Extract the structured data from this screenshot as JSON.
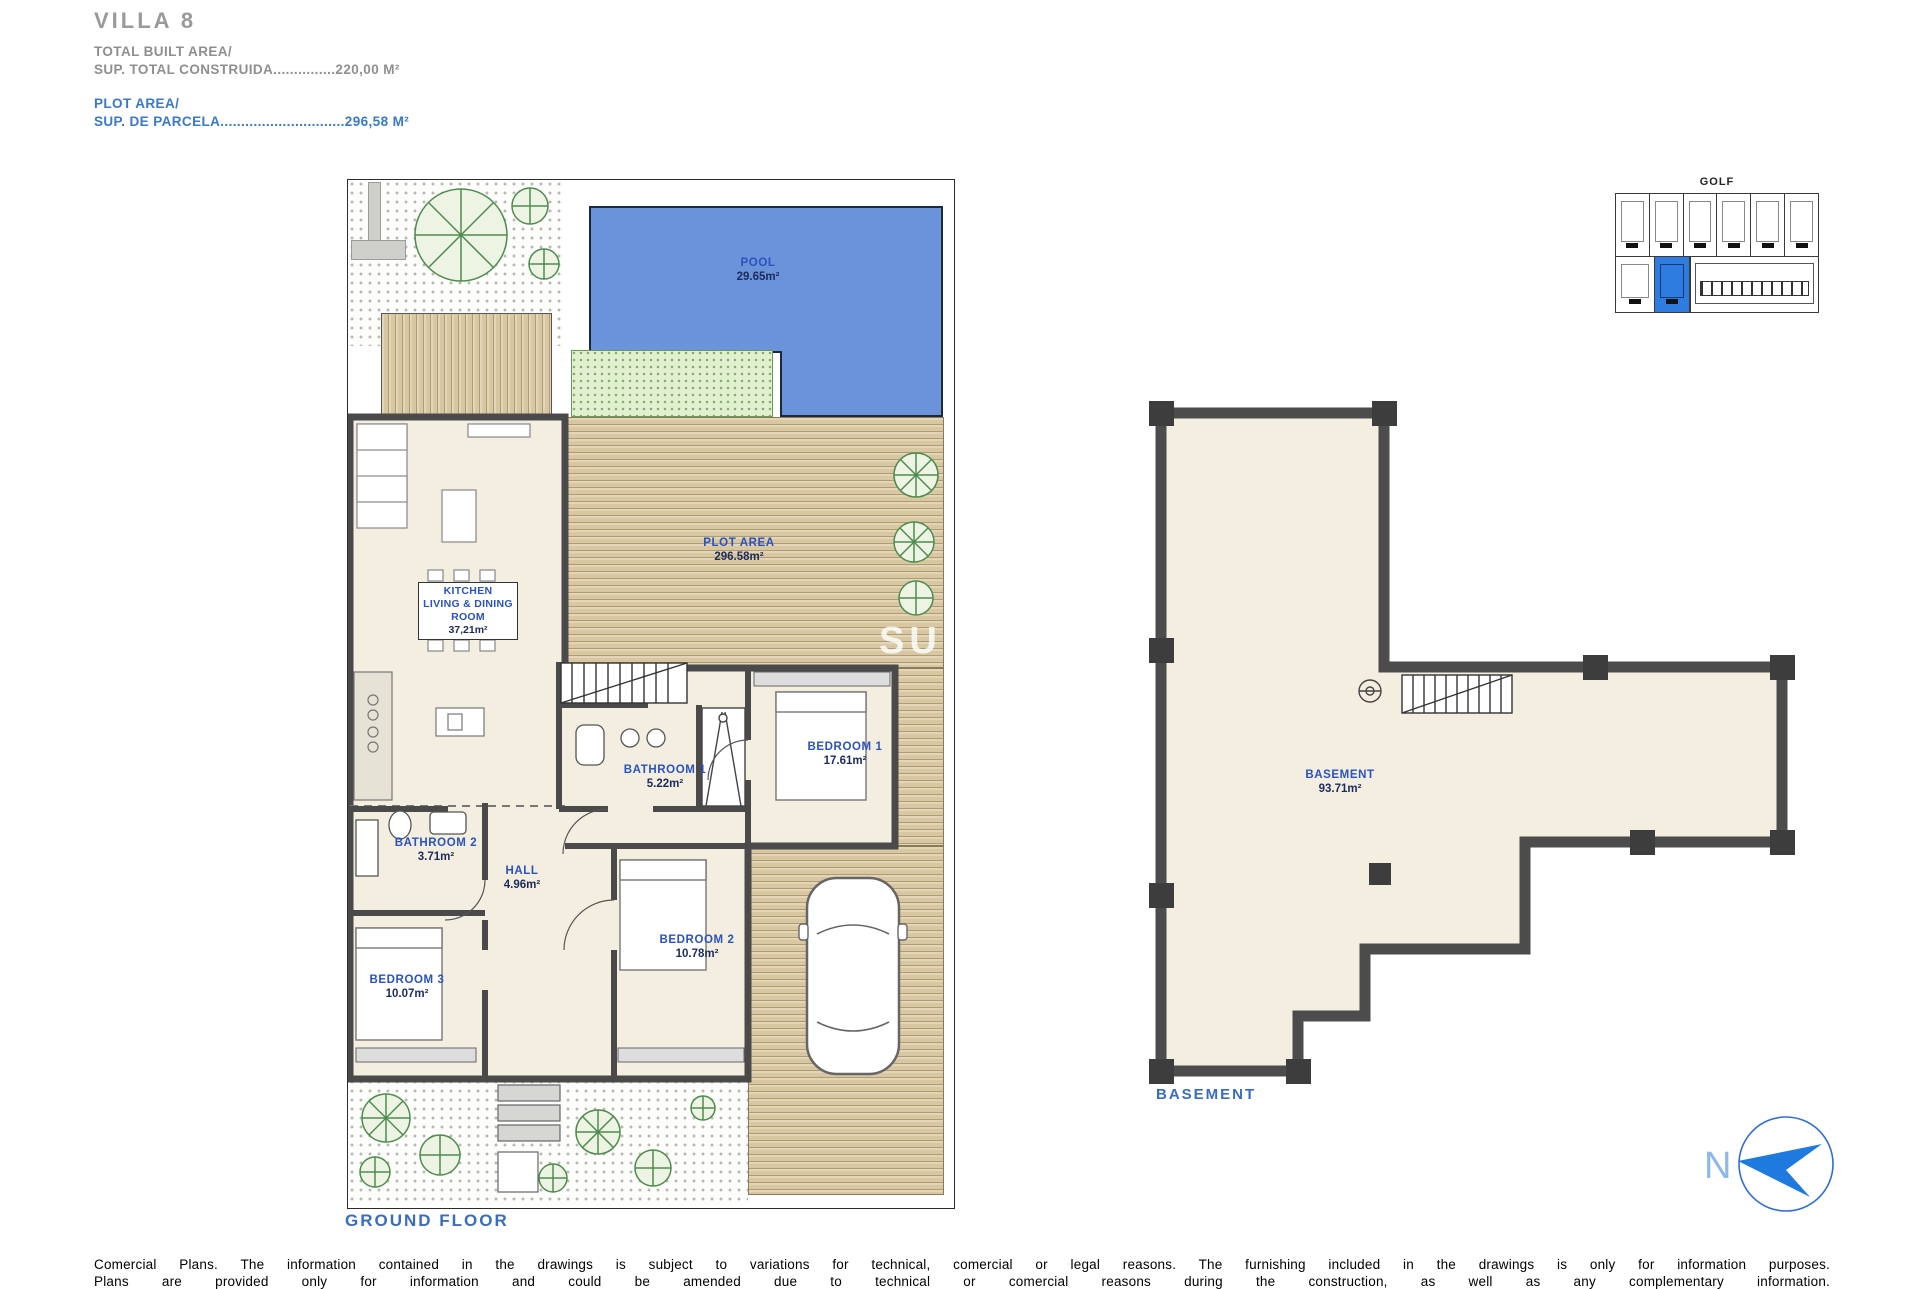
{
  "header": {
    "title": "VILLA 8",
    "built_area_line1": "TOTAL BUILT AREA/",
    "built_area_line2": "SUP. TOTAL CONSTRUIDA...............220,00 M²",
    "plot_area_line1": "PLOT AREA/",
    "plot_area_line2": "SUP. DE PARCELA..............................296,58 M²"
  },
  "ground_floor": {
    "caption": "GROUND FLOOR",
    "watermark": "SUNS",
    "pool": {
      "label": "POOL",
      "area": "29.65m²"
    },
    "plot": {
      "label": "PLOT AREA",
      "area": "296.58m²"
    },
    "kitchen": {
      "line1": "KITCHEN",
      "line2": "LIVING & DINING",
      "line3": "ROOM",
      "area": "37,21m²"
    },
    "bathroom1": {
      "label": "BATHROOM 1",
      "area": "5.22m²"
    },
    "bedroom1": {
      "label": "BEDROOM 1",
      "area": "17.61m²"
    },
    "bathroom2": {
      "label": "BATHROOM 2",
      "area": "3.71m²"
    },
    "hall": {
      "label": "HALL",
      "area": "4.96m²"
    },
    "bedroom2": {
      "label": "BEDROOM 2",
      "area": "10.78m²"
    },
    "bedroom3": {
      "label": "BEDROOM 3",
      "area": "10.07m²"
    }
  },
  "basement": {
    "caption": "BASEMENT",
    "room_label": "BASEMENT",
    "room_area": "93.71m²"
  },
  "site_map": {
    "label": "GOLF"
  },
  "compass": {
    "letter": "N"
  },
  "footer": {
    "line1": "Comercial Plans. The information contained in the drawings is subject to variations for technical, comercial or legal reasons. The furnishing included in the drawings is only for information purposes.",
    "line2": "Plans are provided only for information and could be amended due to technical or comercial reasons during the construction, as well as any complementary information."
  },
  "colors": {
    "accent_blue": "#2a52c0",
    "pool_blue": "#6b93da",
    "highlight_blue": "#2e7ce0",
    "deck_tan": "#d8c7a1",
    "wall_gray": "#4a4a4a"
  }
}
